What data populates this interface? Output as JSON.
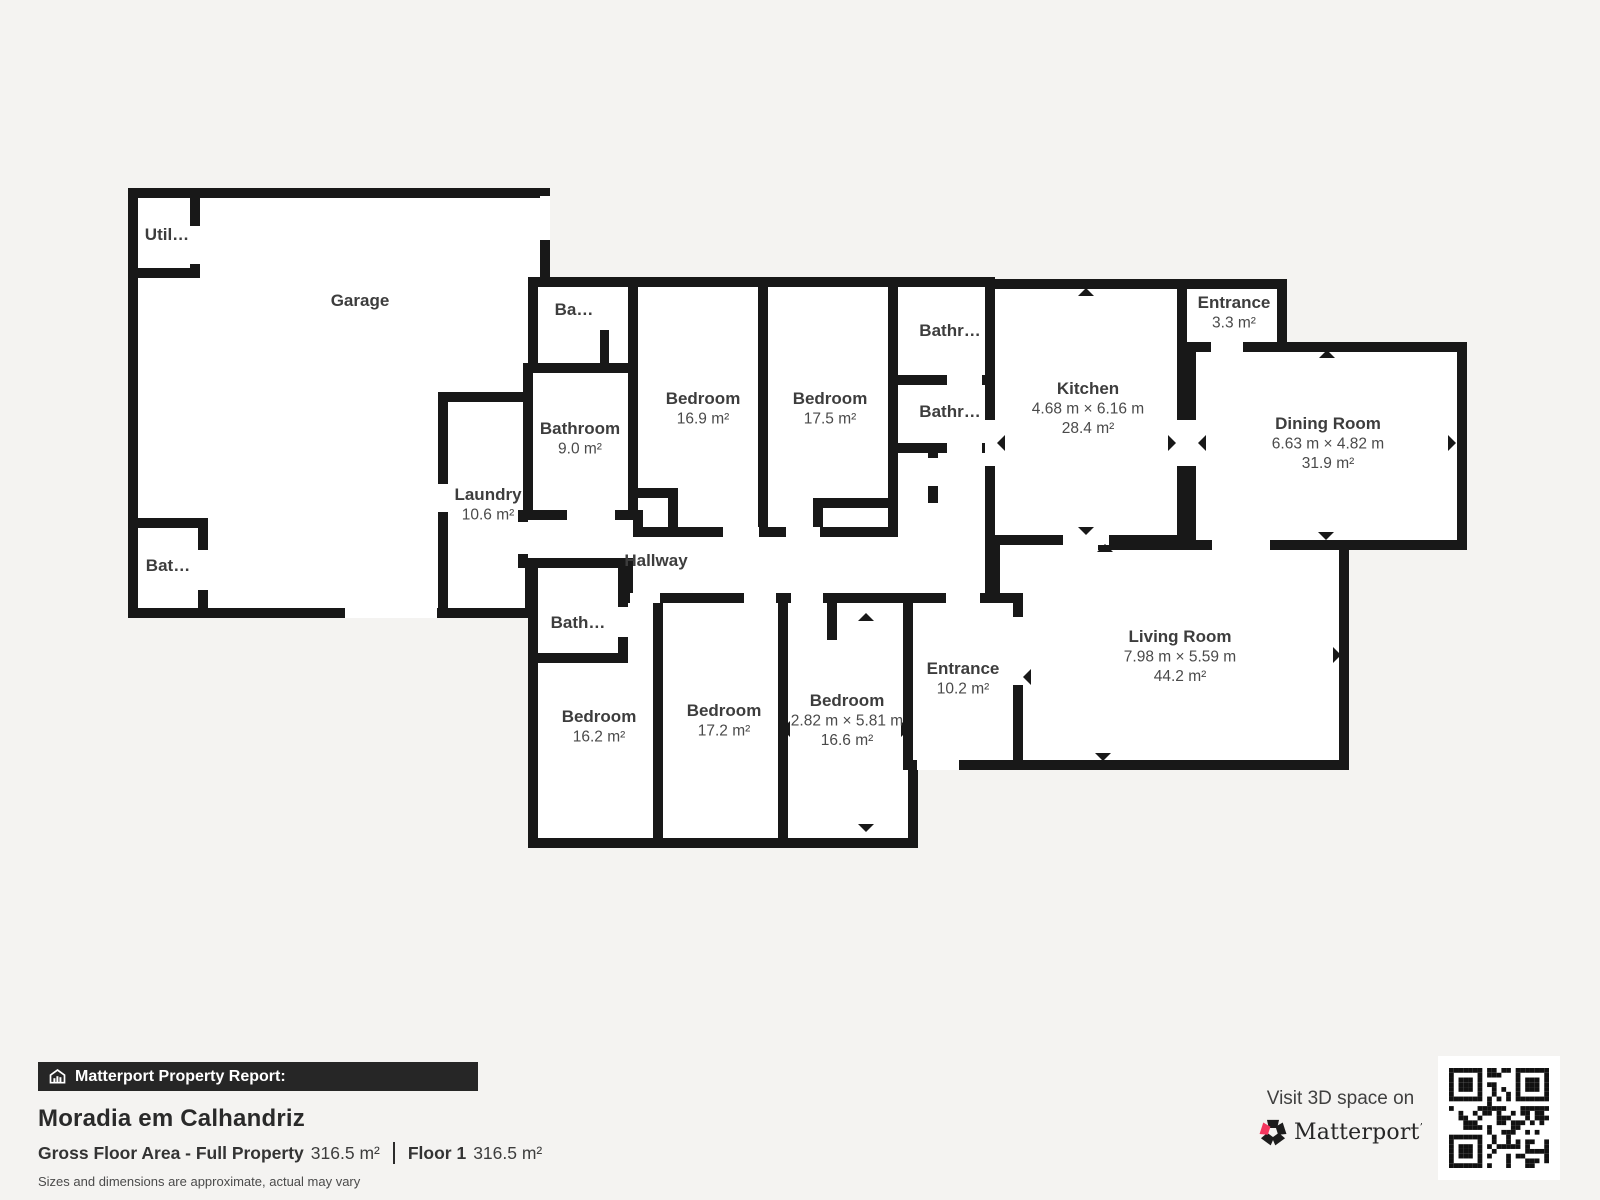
{
  "colors": {
    "page_bg": "#f4f3f1",
    "wall": "#181818",
    "room_fill": "#ffffff",
    "label_text": "#3d3d3d",
    "bar_bg": "#262626",
    "bar_text": "#ffffff",
    "brand_pink": "#f4365e"
  },
  "rooms": [
    {
      "id": "garage",
      "label": "Garage",
      "sub": [],
      "x": 360,
      "y": 302
    },
    {
      "id": "utility",
      "label": "Util…",
      "sub": [],
      "x": 167,
      "y": 236
    },
    {
      "id": "bathroom-garage",
      "label": "Bat…",
      "sub": [],
      "x": 168,
      "y": 567
    },
    {
      "id": "laundry",
      "label": "Laundry",
      "sub": [
        "10.6 m²"
      ],
      "x": 488,
      "y": 496
    },
    {
      "id": "ba-room",
      "label": "Ba…",
      "sub": [],
      "x": 574,
      "y": 311
    },
    {
      "id": "bathroom-9",
      "label": "Bathroom",
      "sub": [
        "9.0 m²"
      ],
      "x": 580,
      "y": 430
    },
    {
      "id": "bedroom-169",
      "label": "Bedroom",
      "sub": [
        "16.9 m²"
      ],
      "x": 703,
      "y": 400
    },
    {
      "id": "bedroom-175",
      "label": "Bedroom",
      "sub": [
        "17.5 m²"
      ],
      "x": 830,
      "y": 400
    },
    {
      "id": "bathroom-upper",
      "label": "Bathr…",
      "sub": [],
      "x": 950,
      "y": 332
    },
    {
      "id": "bathroom-lower",
      "label": "Bathr…",
      "sub": [],
      "x": 950,
      "y": 413
    },
    {
      "id": "kitchen",
      "label": "Kitchen",
      "sub": [
        "4.68 m × 6.16 m",
        "28.4 m²"
      ],
      "x": 1088,
      "y": 390
    },
    {
      "id": "entrance-3",
      "label": "Entrance",
      "sub": [
        "3.3 m²"
      ],
      "x": 1234,
      "y": 304
    },
    {
      "id": "dining-room",
      "label": "Dining Room",
      "sub": [
        "6.63 m × 4.82 m",
        "31.9 m²"
      ],
      "x": 1328,
      "y": 425
    },
    {
      "id": "hallway",
      "label": "Hallway",
      "sub": [],
      "x": 656,
      "y": 562
    },
    {
      "id": "bath-hall",
      "label": "Bath…",
      "sub": [],
      "x": 578,
      "y": 624
    },
    {
      "id": "bedroom-162",
      "label": "Bedroom",
      "sub": [
        "16.2 m²"
      ],
      "x": 599,
      "y": 718
    },
    {
      "id": "bedroom-172",
      "label": "Bedroom",
      "sub": [
        "17.2 m²"
      ],
      "x": 724,
      "y": 712
    },
    {
      "id": "bedroom-166",
      "label": "Bedroom",
      "sub": [
        "2.82 m × 5.81 m",
        "16.6 m²"
      ],
      "x": 847,
      "y": 702
    },
    {
      "id": "entrance-10",
      "label": "Entrance",
      "sub": [
        "10.2 m²"
      ],
      "x": 963,
      "y": 670
    },
    {
      "id": "living-room",
      "label": "Living Room",
      "sub": [
        "7.98 m × 5.59 m",
        "44.2 m²"
      ],
      "x": 1180,
      "y": 638
    }
  ],
  "report": {
    "bar_label": "Matterport Property Report:",
    "title": "Moradia em Calhandriz",
    "gfa_label": "Gross Floor Area - Full Property",
    "gfa_value": "316.5 m²",
    "floor_label": "Floor 1",
    "floor_value": "316.5 m²",
    "disclaimer": "Sizes and dimensions are approximate, actual may vary"
  },
  "cta": {
    "visit": "Visit 3D space on",
    "brand": "Matterport",
    "tm": "’"
  }
}
